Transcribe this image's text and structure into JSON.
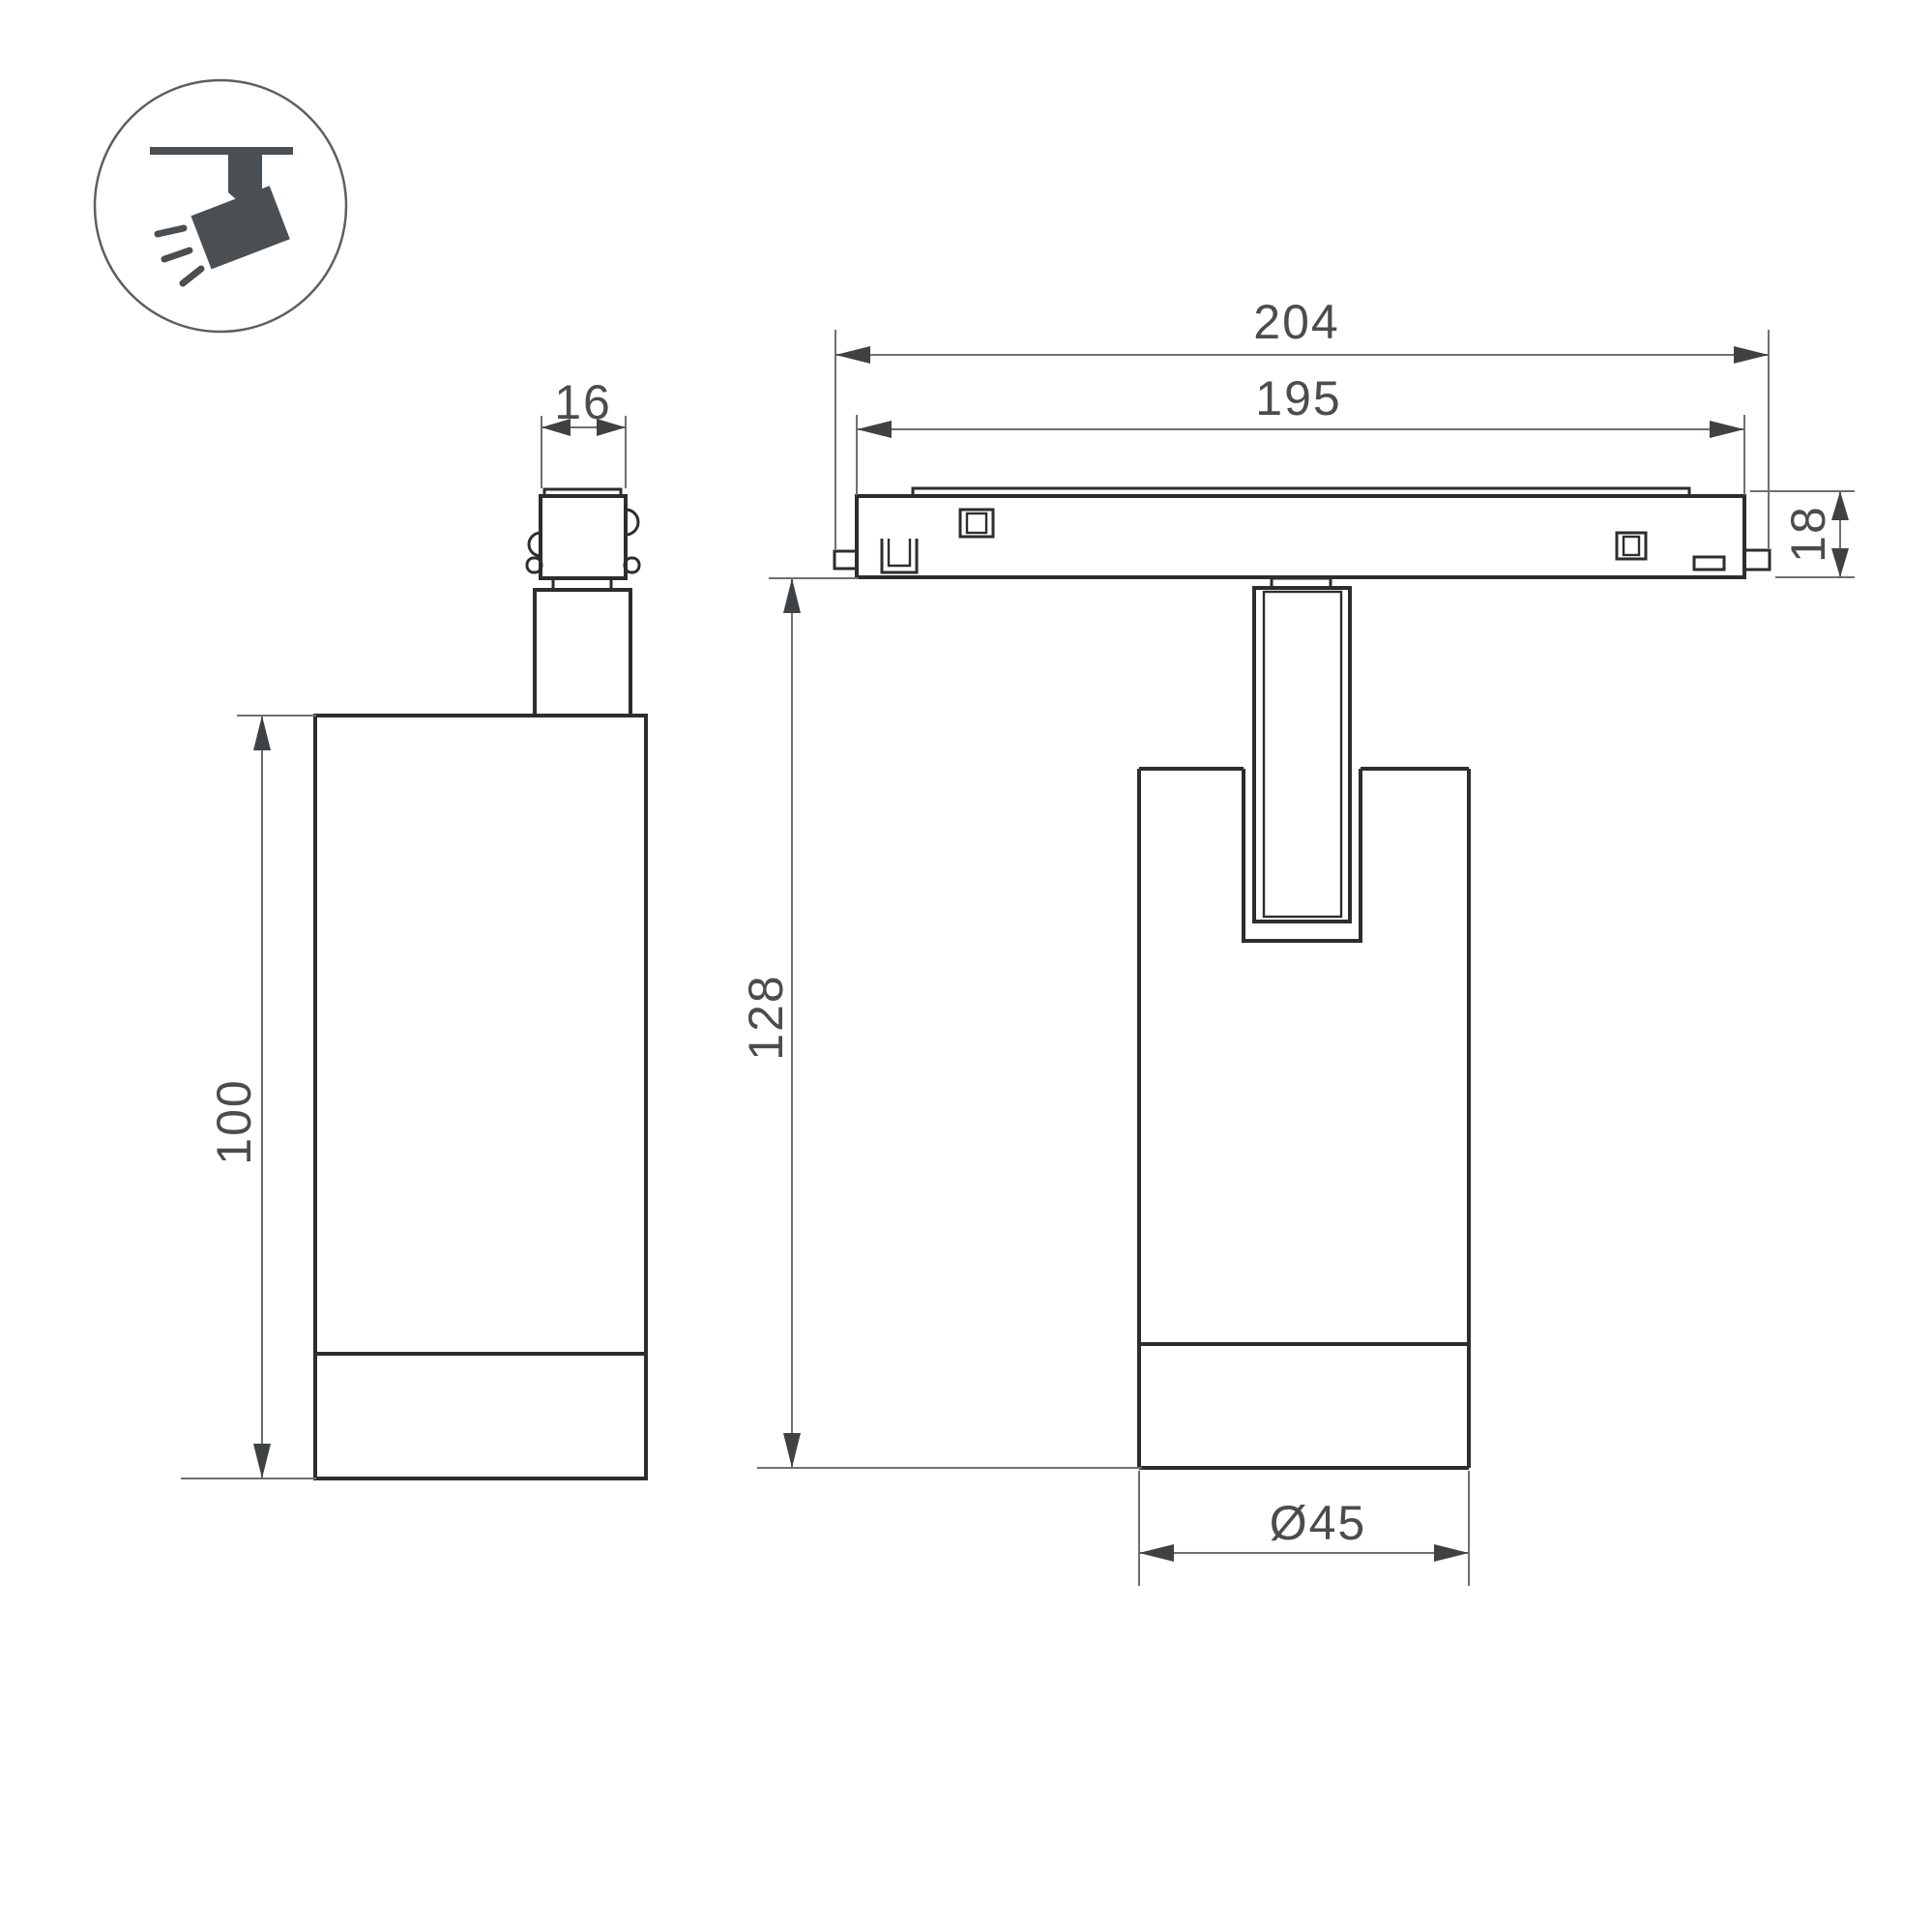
{
  "icon": {
    "name": "ceiling-track-spotlight",
    "fill_color": "#4a4f54",
    "ring_color": "#5a5f63"
  },
  "dimensions": {
    "adapter_width": "16",
    "track_length_overall": "204",
    "track_length_body": "195",
    "track_height": "18",
    "spot_body_height": "100",
    "overall_height": "128",
    "body_diameter": "Ø45"
  },
  "colors": {
    "background": "#ffffff",
    "part_outline": "#2d2d2d",
    "dimension_line": "#6f6f6f",
    "dimension_arrow": "#3e4245",
    "dimension_text": "#4c4c4c"
  }
}
